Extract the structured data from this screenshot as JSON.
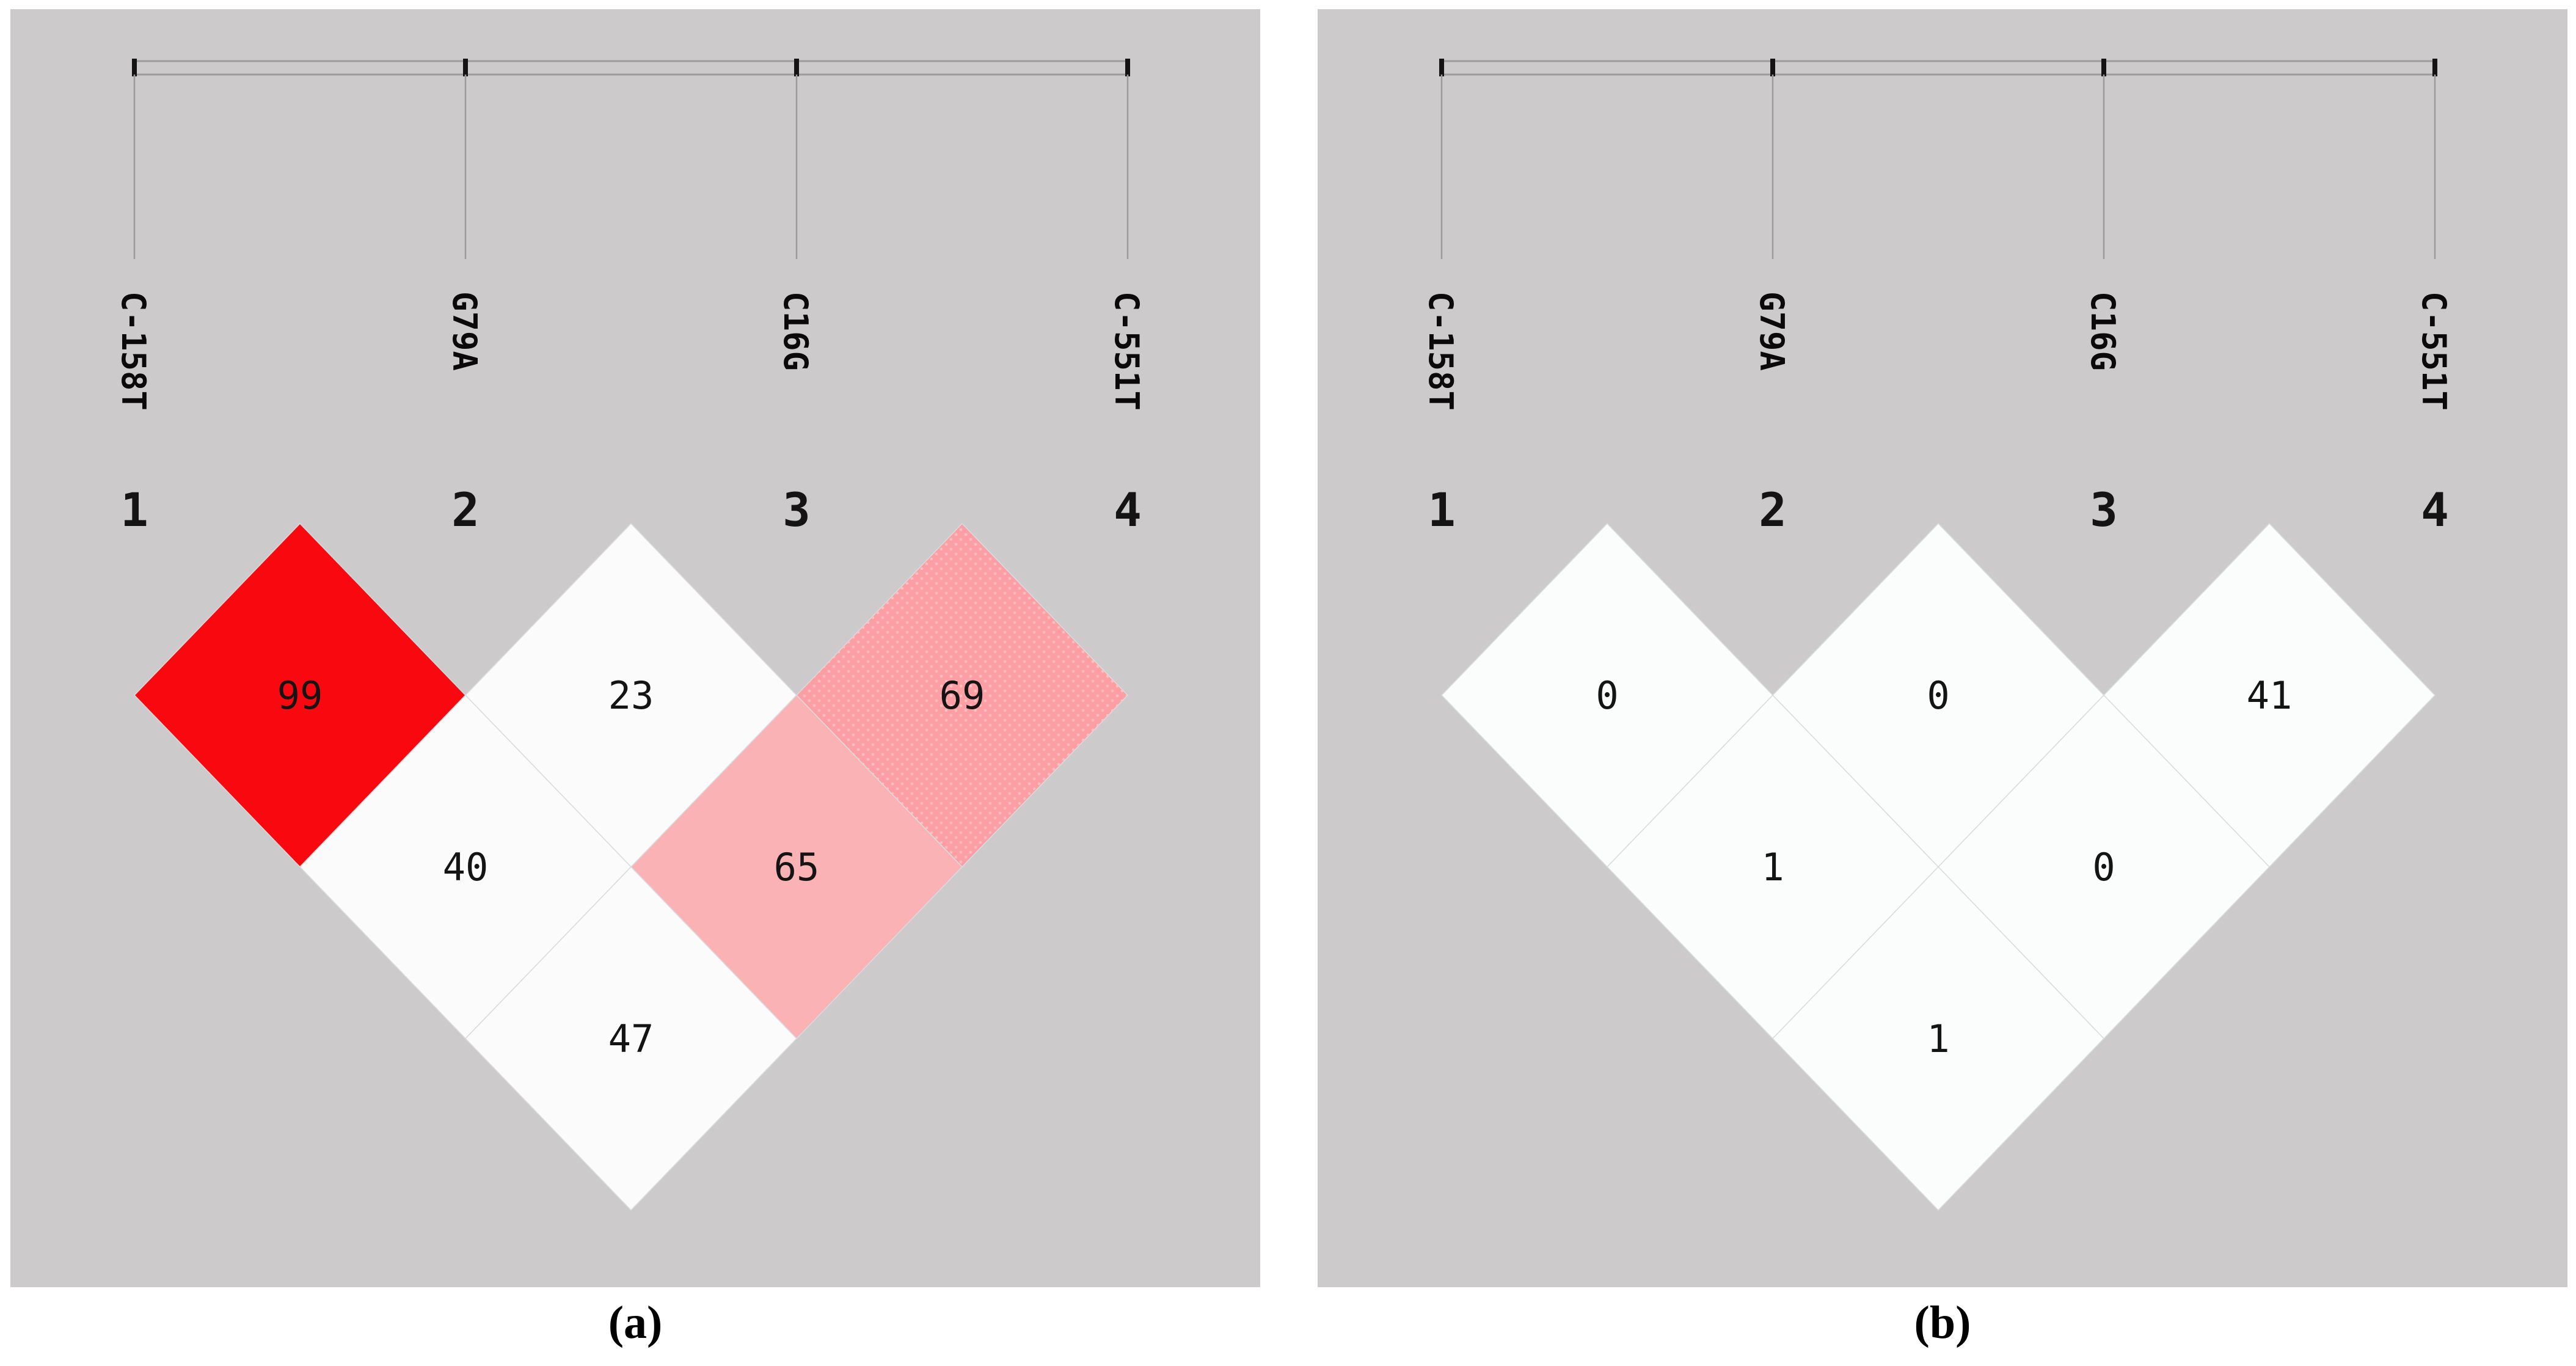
{
  "figure": {
    "type": "linkage-disequilibrium-plot",
    "caption_a": "(a)",
    "caption_b": "(b)"
  },
  "colors": {
    "panel_background": "#CDCACC",
    "ld_red": "#F9090F",
    "ld_pink_dotted": "#FC9EA3",
    "ld_pink_dot_speckle": "#FDC0C3",
    "ld_pink_light": "#FBB2B4",
    "ld_white_a": "#FBFBFC",
    "ld_white_b": "#FAFDFB",
    "line_gray": "#9B9B9B",
    "tick_black": "#141414"
  },
  "panels": [
    {
      "caption": "(a)",
      "markers": [
        {
          "number": "1",
          "label": "C-158T"
        },
        {
          "number": "2",
          "label": "G79A"
        },
        {
          "number": "3",
          "label": "C16G"
        },
        {
          "number": "4",
          "label": "C-551T"
        }
      ],
      "diamonds": [
        {
          "pair": "1-2",
          "value": "99",
          "fill": "#F9090F",
          "texture": "solid"
        },
        {
          "pair": "2-3",
          "value": "23",
          "fill": "#FBFBFC",
          "texture": "solid"
        },
        {
          "pair": "3-4",
          "value": "69",
          "fill": "#FC9EA3",
          "texture": "dotted"
        },
        {
          "pair": "1-3",
          "value": "40",
          "fill": "#FBFBFC",
          "texture": "solid"
        },
        {
          "pair": "2-4",
          "value": "65",
          "fill": "#FBB2B4",
          "texture": "solid"
        },
        {
          "pair": "1-4",
          "value": "47",
          "fill": "#FBFBFC",
          "texture": "solid"
        }
      ]
    },
    {
      "caption": "(b)",
      "markers": [
        {
          "number": "1",
          "label": "C-158T"
        },
        {
          "number": "2",
          "label": "G79A"
        },
        {
          "number": "3",
          "label": "C16G"
        },
        {
          "number": "4",
          "label": "C-551T"
        }
      ],
      "diamonds": [
        {
          "pair": "1-2",
          "value": "0",
          "fill": "#FAFDFB",
          "texture": "solid"
        },
        {
          "pair": "2-3",
          "value": "0",
          "fill": "#FAFDFB",
          "texture": "solid"
        },
        {
          "pair": "3-4",
          "value": "41",
          "fill": "#FAFDFB",
          "texture": "solid"
        },
        {
          "pair": "1-3",
          "value": "1",
          "fill": "#FAFDFB",
          "texture": "solid"
        },
        {
          "pair": "2-4",
          "value": "0",
          "fill": "#FAFDFB",
          "texture": "solid"
        },
        {
          "pair": "1-4",
          "value": "1",
          "fill": "#FAFDFB",
          "texture": "solid"
        }
      ]
    }
  ],
  "chart_data": [
    {
      "type": "heatmap",
      "title": "(a)",
      "subtitle": "pairwise LD values (D' x100)",
      "markers": [
        "C-158T",
        "G79A",
        "C16G",
        "C-551T"
      ],
      "marker_numbers": [
        1,
        2,
        3,
        4
      ],
      "pairwise_values": {
        "1-2": 99,
        "2-3": 23,
        "3-4": 69,
        "1-3": 40,
        "2-4": 65,
        "1-4": 47
      },
      "shading": {
        "1-2": "red",
        "2-3": "white",
        "3-4": "dotted-pink",
        "1-3": "white",
        "2-4": "pink",
        "1-4": "white"
      },
      "legend_position": "none",
      "grid": false
    },
    {
      "type": "heatmap",
      "title": "(b)",
      "subtitle": "pairwise LD values (r2 x100)",
      "markers": [
        "C-158T",
        "G79A",
        "C16G",
        "C-551T"
      ],
      "marker_numbers": [
        1,
        2,
        3,
        4
      ],
      "pairwise_values": {
        "1-2": 0,
        "2-3": 0,
        "3-4": 41,
        "1-3": 1,
        "2-4": 0,
        "1-4": 1
      },
      "shading": {
        "1-2": "white",
        "2-3": "white",
        "3-4": "white",
        "1-3": "white",
        "2-4": "white",
        "1-4": "white"
      },
      "legend_position": "none",
      "grid": false
    }
  ]
}
